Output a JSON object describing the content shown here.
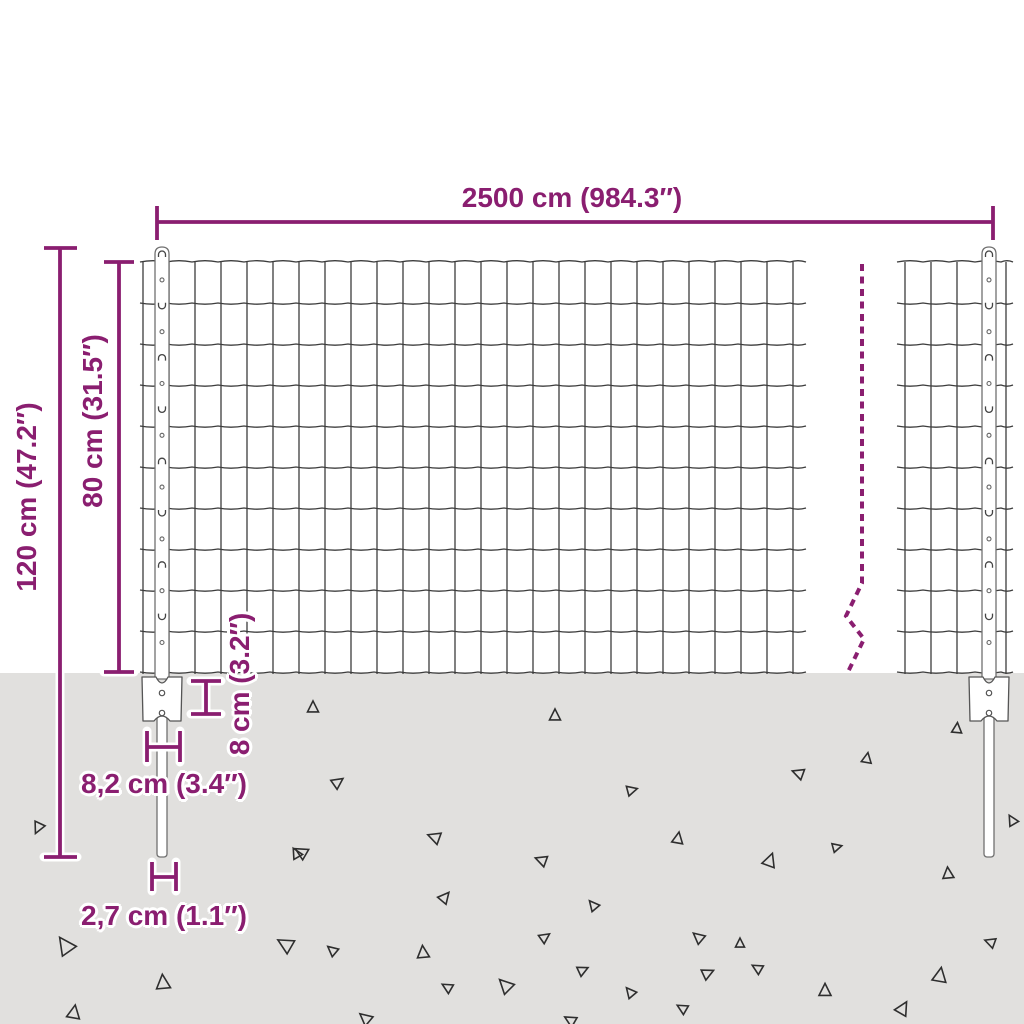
{
  "title": "fence-panel-dimension-diagram",
  "colors": {
    "accent": "#8a1e70",
    "background": "#ffffff",
    "ground": "#e1e0de",
    "wire": "#3d3d3d",
    "post_fill": "#ffffff",
    "post_outline": "#707070",
    "triangle": "#2e2e2e"
  },
  "labels": {
    "total_width": "2500 cm (984.3″)",
    "post_height": "120 cm (47.2″)",
    "fence_height": "80 cm (31.5″)",
    "plate_depth": "8 cm (3.2″)",
    "plate_width": "8,2 cm (3.4″)",
    "post_width": "2,7 cm (1.1″)"
  },
  "figure": {
    "ground_top": 673,
    "rows": {
      "y0": 262,
      "count": 11,
      "step": 41,
      "y_bottom": 674
    },
    "mesh_left": {
      "vx0": 143,
      "v_count": 26,
      "v_step": 26,
      "h_x1": 140,
      "h_x2": 806
    },
    "mesh_right": {
      "verticals": [
        905,
        931,
        957,
        1006
      ],
      "h_x1": 897,
      "h_x2": 1013
    },
    "posts": {
      "centers": [
        162,
        989
      ],
      "top_y": 247,
      "half_w": 7,
      "plate_top": 677,
      "plate_bot": 721,
      "plate_half_w": 20,
      "spike_top": 716,
      "spike_bot": 857,
      "spike_half_w": 5
    },
    "break_line": "862,264 862,583 846,616 864,639 847,674",
    "dimensions": {
      "total_width": [
        [
          157,
          222,
          993,
          222
        ],
        [
          157,
          206,
          157,
          240
        ],
        [
          993,
          206,
          993,
          240
        ]
      ],
      "post_height": [
        [
          60,
          248,
          60,
          857
        ],
        [
          44,
          248,
          77,
          248
        ],
        [
          44,
          857,
          77,
          857
        ]
      ],
      "fence_height": [
        [
          119,
          262,
          119,
          672
        ],
        [
          104,
          262,
          134,
          262
        ],
        [
          104,
          672,
          134,
          672
        ]
      ],
      "plate_depth": [
        [
          206,
          681,
          206,
          714
        ],
        [
          191,
          681,
          221,
          681
        ],
        [
          191,
          714,
          221,
          714
        ]
      ],
      "plate_width": [
        [
          147,
          747,
          180,
          747
        ],
        [
          147,
          731,
          147,
          762
        ],
        [
          180,
          731,
          180,
          762
        ]
      ],
      "post_width": [
        [
          152,
          877,
          176,
          877
        ],
        [
          152,
          862,
          152,
          891
        ],
        [
          176,
          862,
          176,
          891
        ]
      ]
    },
    "triangles": [
      [
        38,
        828,
        11,
        205
      ],
      [
        65,
        945,
        17,
        325
      ],
      [
        74,
        1012,
        13,
        10
      ],
      [
        163,
        982,
        14,
        355
      ],
      [
        285,
        944,
        15,
        300
      ],
      [
        296,
        853,
        10,
        330
      ],
      [
        313,
        707,
        11,
        0
      ],
      [
        332,
        950,
        10,
        310
      ],
      [
        338,
        782,
        11,
        55
      ],
      [
        301,
        852,
        12,
        300
      ],
      [
        365,
        1018,
        12,
        310
      ],
      [
        423,
        952,
        12,
        355
      ],
      [
        434,
        837,
        12,
        290
      ],
      [
        447,
        987,
        10,
        300
      ],
      [
        445,
        897,
        11,
        40
      ],
      [
        505,
        985,
        14,
        315
      ],
      [
        545,
        937,
        10,
        55
      ],
      [
        555,
        715,
        11,
        0
      ],
      [
        541,
        860,
        11,
        290
      ],
      [
        583,
        970,
        10,
        65
      ],
      [
        570,
        1020,
        11,
        300
      ],
      [
        593,
        905,
        10,
        320
      ],
      [
        632,
        790,
        10,
        75
      ],
      [
        630,
        992,
        10,
        320
      ],
      [
        678,
        838,
        11,
        10
      ],
      [
        698,
        937,
        11,
        310
      ],
      [
        708,
        973,
        11,
        65
      ],
      [
        740,
        943,
        9,
        0
      ],
      [
        757,
        968,
        10,
        300
      ],
      [
        770,
        860,
        13,
        20
      ],
      [
        798,
        773,
        11,
        290
      ],
      [
        825,
        990,
        12,
        0
      ],
      [
        837,
        847,
        9,
        75
      ],
      [
        867,
        758,
        10,
        10
      ],
      [
        903,
        1008,
        13,
        30
      ],
      [
        940,
        975,
        14,
        10
      ],
      [
        948,
        873,
        11,
        355
      ],
      [
        957,
        728,
        10,
        5
      ],
      [
        990,
        942,
        10,
        290
      ],
      [
        1012,
        820,
        10,
        330
      ],
      [
        682,
        1008,
        10,
        300
      ]
    ]
  }
}
